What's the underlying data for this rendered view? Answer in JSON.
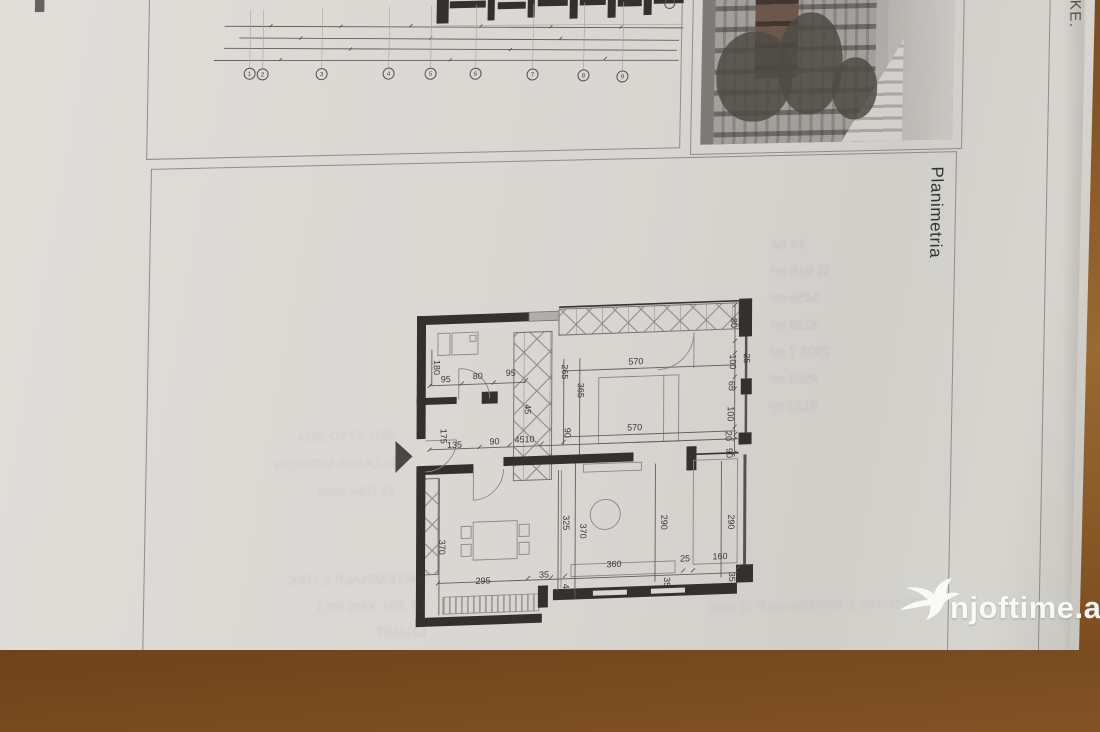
{
  "page": {
    "page_number": "21",
    "margin_text": "OKE.",
    "plan_box_label": "Planimetria"
  },
  "watermark": {
    "text": "njoftime.al",
    "icon": "swallow-bird-icon",
    "color": "#fbfbf9"
  },
  "colors": {
    "paper": "#d9d7d2",
    "wood_table": "#8a5a28",
    "wall": "#33312e",
    "box_border": "#8f8d89",
    "dimension_text": "#3b3936"
  },
  "top_drawing": {
    "grid_bubbles": [
      {
        "n": "1",
        "x": 101,
        "y": 84
      },
      {
        "n": "2",
        "x": 114,
        "y": 85
      },
      {
        "n": "3",
        "x": 173,
        "y": 86
      },
      {
        "n": "4",
        "x": 240,
        "y": 87
      },
      {
        "n": "5",
        "x": 282,
        "y": 88
      },
      {
        "n": "6",
        "x": 327,
        "y": 89
      },
      {
        "n": "7",
        "x": 384,
        "y": 91
      },
      {
        "n": "8",
        "x": 435,
        "y": 93
      },
      {
        "n": "9",
        "x": 474,
        "y": 95
      }
    ]
  },
  "floor_plan": {
    "dimensions": [
      {
        "v": "180",
        "x": 40,
        "y": 64,
        "r": 90
      },
      {
        "v": "95",
        "x": 52,
        "y": 79,
        "r": 0
      },
      {
        "v": "80",
        "x": 84,
        "y": 77,
        "r": 0
      },
      {
        "v": "95",
        "x": 117,
        "y": 75,
        "r": 0
      },
      {
        "v": "265",
        "x": 168,
        "y": 73,
        "r": 90
      },
      {
        "v": "365",
        "x": 184,
        "y": 92,
        "r": 90
      },
      {
        "v": "570",
        "x": 242,
        "y": 68,
        "r": 0
      },
      {
        "v": "570",
        "x": 241,
        "y": 134,
        "r": 0
      },
      {
        "v": "80",
        "x": 337,
        "y": 30,
        "r": 90
      },
      {
        "v": "100",
        "x": 336,
        "y": 69,
        "r": 90
      },
      {
        "v": "25",
        "x": 350,
        "y": 66,
        "r": 90
      },
      {
        "v": "65",
        "x": 335,
        "y": 93,
        "r": 90
      },
      {
        "v": "100",
        "x": 334,
        "y": 121,
        "r": 90
      },
      {
        "v": "20",
        "x": 332,
        "y": 143,
        "r": 90
      },
      {
        "v": "90",
        "x": 333,
        "y": 160,
        "r": 90
      },
      {
        "v": "175",
        "x": 47,
        "y": 133,
        "r": 90
      },
      {
        "v": "135",
        "x": 61,
        "y": 145,
        "r": 0
      },
      {
        "v": "90",
        "x": 101,
        "y": 143,
        "r": 0
      },
      {
        "v": "4510",
        "x": 131,
        "y": 142,
        "r": 0
      },
      {
        "v": "45",
        "x": 131,
        "y": 109,
        "r": 90
      },
      {
        "v": "90",
        "x": 171,
        "y": 134,
        "r": 90
      },
      {
        "v": "370",
        "x": 46,
        "y": 244,
        "r": 90
      },
      {
        "v": "325",
        "x": 170,
        "y": 224,
        "r": 90
      },
      {
        "v": "370",
        "x": 187,
        "y": 233,
        "r": 90
      },
      {
        "v": "290",
        "x": 268,
        "y": 227,
        "r": 90
      },
      {
        "v": "290",
        "x": 335,
        "y": 229,
        "r": 90
      },
      {
        "v": "295",
        "x": 90,
        "y": 282,
        "r": 0
      },
      {
        "v": "35",
        "x": 151,
        "y": 278,
        "r": 0
      },
      {
        "v": "45",
        "x": 170,
        "y": 290,
        "r": 90
      },
      {
        "v": "360",
        "x": 221,
        "y": 270,
        "r": 0
      },
      {
        "v": "25",
        "x": 292,
        "y": 267,
        "r": 0
      },
      {
        "v": "160",
        "x": 327,
        "y": 266,
        "r": 0
      },
      {
        "v": "35",
        "x": 271,
        "y": 287,
        "r": 90
      },
      {
        "v": "35",
        "x": 336,
        "y": 284,
        "r": 90
      }
    ]
  },
  "bleed_through": {
    "note": "illegible mirrored text showing through from the reverse side of the page",
    "areas_column": [
      "14 64",
      "11 616 m²",
      "3459 m²",
      "3238 m²",
      "2903 7 m²",
      "4553 m²",
      "9122 m²"
    ],
    "mid_lines": [
      "8811 ETYD 2014",
      "ELLAKHS MITREDN",
      "12 ITAK 3904"
    ],
    "bottom_lines": [
      "AIRTEMINALP E ITAK",
      "12 .RN .KHS 05:1",
      "ENARIT"
    ],
    "corner_lines": [
      "ETYD ITAK E AIRTEMINALP 12 KHS"
    ]
  }
}
